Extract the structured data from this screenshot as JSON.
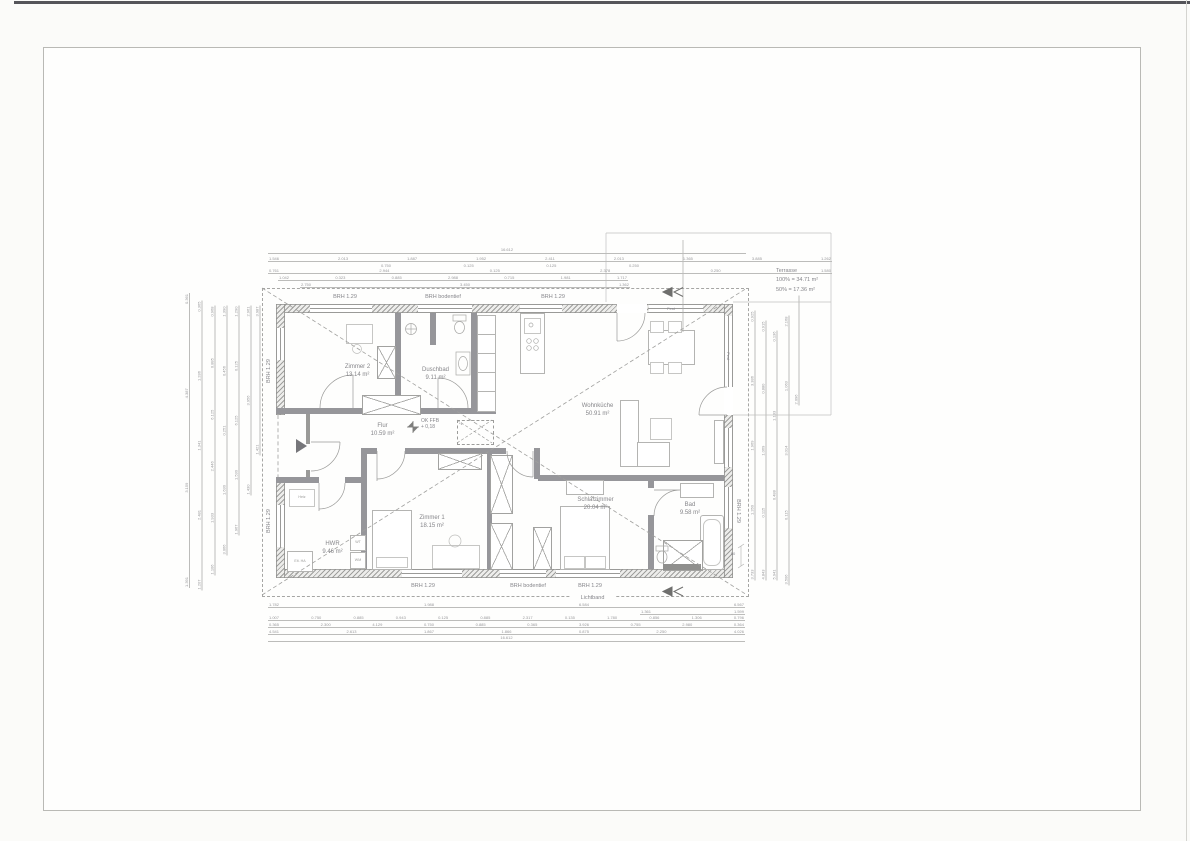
{
  "rooms": {
    "zimmer2": {
      "name": "Zimmer 2",
      "area": "13.14 m²"
    },
    "duschbad": {
      "name": "Duschbad",
      "area": "9.11 m²"
    },
    "wohnkueche": {
      "name": "Wohnküche",
      "area": "50.91 m²"
    },
    "flur": {
      "name": "Flur",
      "area": "10.59 m²"
    },
    "zimmer1": {
      "name": "Zimmer 1",
      "area": "18.15 m²"
    },
    "schlafzimmer": {
      "name": "Schlafzimmer",
      "area": "20.04 m²"
    },
    "bad": {
      "name": "Bad",
      "area": "9.58 m²"
    },
    "hwr": {
      "name": "HWR",
      "area": "9.46 m²"
    }
  },
  "annotations": {
    "brh": "BRH 1.29",
    "brh_bodentief": "BRH bodentief",
    "lichtband": "Lichtband",
    "fest": "Fest",
    "ok_ffb": "OK FFB",
    "ok_ffb_value": "+ 0,18",
    "star1": "*1",
    "terrasse_title": "Terrasse",
    "terrasse_100": "100% = 34.71 m²",
    "terrasse_50": "50% = 17.36 m²",
    "heiz": "Heiz",
    "elt_ha": "Elt. HA",
    "wt": "WT",
    "wm": "WM",
    "dim50": "50"
  },
  "dimensions": {
    "top": {
      "total": "16.612",
      "row2": [
        "1.546",
        "2.013",
        "1.887",
        "1.952",
        "2.411",
        "2.013",
        "1.365",
        "3.885",
        "1.262"
      ],
      "row2b": [
        "0.750",
        "0.125",
        "0.125",
        "0.250"
      ],
      "row3": [
        "0.761",
        "2.944",
        "0.125",
        "2.378",
        "0.250",
        "1.580"
      ],
      "row4": [
        "1.042",
        "0.323",
        "0.885",
        "2.988",
        "0.715",
        "1.981",
        "1.717"
      ],
      "row5": [
        "2.750",
        "3.450",
        "1.362"
      ]
    },
    "bottom": {
      "row1": [
        "1.782",
        "1.988",
        "6.584",
        "6.567"
      ],
      "row1b": [
        "1.361",
        "1.599"
      ],
      "row2": [
        "1.007",
        "0.750",
        "0.885",
        "0.943",
        "0.125",
        "0.885",
        "2.317",
        "0.135",
        "1.780",
        "0.856",
        "1.306",
        "0.796"
      ],
      "row3": [
        "0.365",
        "2.300",
        "4.129",
        "0.750",
        "0.885",
        "0.365",
        "3.926",
        "0.755",
        "2.980",
        "0.364"
      ],
      "row4": [
        "4.541",
        "2.613",
        "1.867",
        "1.866",
        "0.875",
        "2.250",
        "4.026"
      ],
      "total": "16.612"
    },
    "left": {
      "col1": [
        "1.391",
        "3.159",
        "4.387",
        "0.361"
      ],
      "col2": [
        "1.207",
        "2.481",
        "1.341",
        "1.286",
        "0.365"
      ],
      "col3": [
        "1.106",
        "1.933",
        "2.446",
        "6.125",
        "0.885",
        "0.968"
      ],
      "col4": [
        "3.066",
        "1.630",
        "0.251",
        "0.456",
        "1.390"
      ],
      "col5": [
        "1.967",
        "1.530",
        "6.125",
        "0.125",
        "1.290"
      ],
      "col6": [
        "1.430",
        "3.956",
        "2.961"
      ],
      "col7": [
        "1.421",
        "3.987"
      ]
    },
    "right": {
      "col1": [
        "3.733",
        "1.260",
        "1.969",
        "3.386",
        "0.925"
      ],
      "col2": [
        "4.843",
        "0.115",
        "1.069",
        "0.880",
        "0.915"
      ],
      "col3": [
        "5.941",
        "0.488",
        "1.133",
        "0.136"
      ],
      "col4": [
        "3.506",
        "0.115",
        "3.014",
        "1.063",
        "2.168"
      ],
      "col5": [
        "2.096"
      ]
    }
  }
}
